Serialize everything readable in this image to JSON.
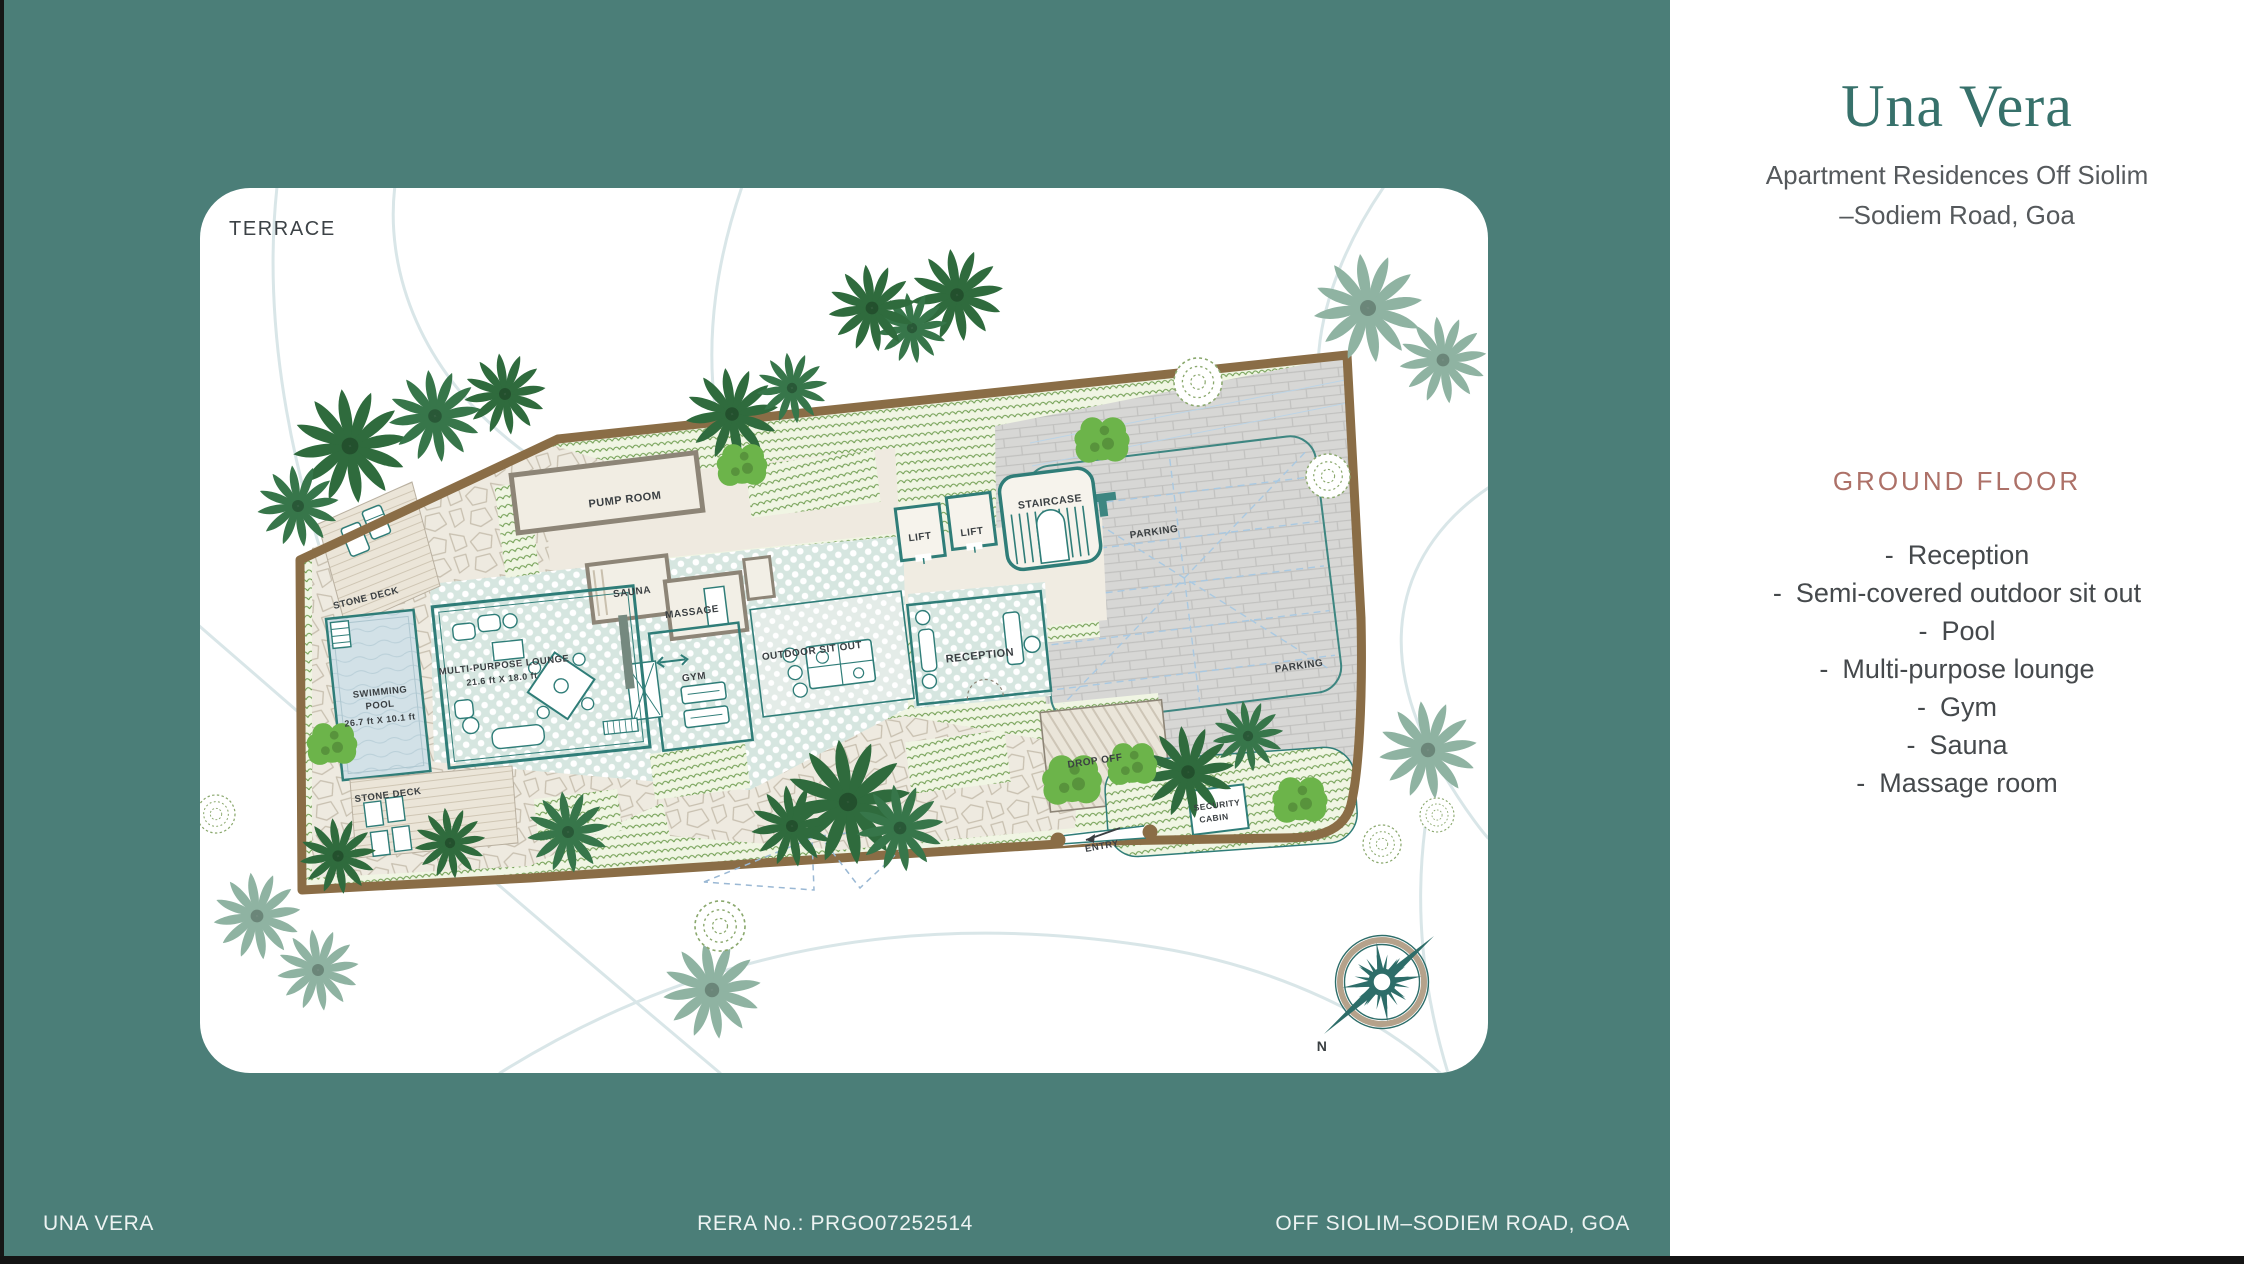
{
  "colors": {
    "teal_background": "#4b7e78",
    "title_teal": "#37716b",
    "heading_rose": "#ad7168",
    "boundary_brown": "#8a6d46",
    "plan_teal": "#2f7d78",
    "lawn_green": "#6d9c4e"
  },
  "card": {
    "terrace_label": "TERRACE"
  },
  "brand": {
    "title": "Una Vera",
    "subtitle_line1": "Apartment Residences Off Siolim",
    "subtitle_line2": "–Sodiem Road, Goa"
  },
  "ground_floor": {
    "heading": "GROUND FLOOR",
    "bullet": "-",
    "items": [
      "Reception",
      "Semi-covered outdoor sit out",
      "Pool",
      "Multi-purpose lounge",
      "Gym",
      "Sauna",
      "Massage room"
    ]
  },
  "plan_labels": {
    "pump_room": "PUMP ROOM",
    "sauna": "SAUNA",
    "massage": "MASSAGE",
    "gym": "GYM",
    "lounge_line1": "MULTI-PURPOSE LOUNGE",
    "lounge_line2": "21.6 ft X 18.0 ft",
    "swimming_line1": "SWIMMING",
    "swimming_line2": "POOL",
    "swimming_dims": "26.7 ft X 10.1 ft",
    "stone_deck_top": "STONE DECK",
    "stone_deck_bottom": "STONE DECK",
    "outdoor_sit_out": "OUTDOOR SIT OUT",
    "lift1": "LIFT",
    "lift2": "LIFT",
    "staircase": "STAIRCASE",
    "reception": "RECEPTION",
    "parking1": "PARKING",
    "parking2": "PARKING",
    "drop_off": "DROP OFF",
    "security_line1": "SECURITY",
    "security_line2": "CABIN",
    "entry": "ENTRY",
    "compass_north": "N"
  },
  "footer": {
    "left": "UNA VERA",
    "center": "RERA No.: PRGO07252514",
    "right": "OFF SIOLIM–SODIEM ROAD, GOA"
  }
}
